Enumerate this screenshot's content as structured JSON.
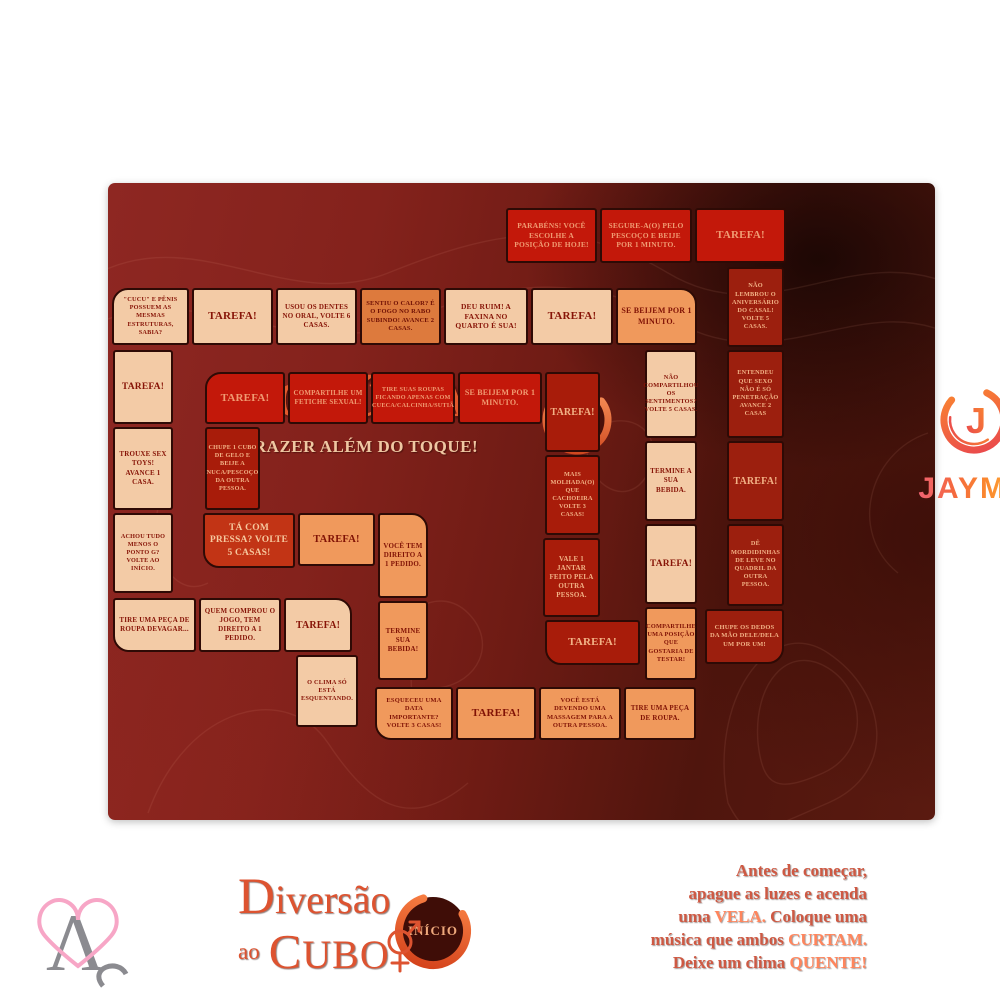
{
  "board": {
    "title": "VOLÚPIA",
    "subtitle": "PRAZER ALÉM DO TOQUE!",
    "end_label": "FIM",
    "start_label": "INÍCIO",
    "brand": {
      "wordmark": "JAYMA",
      "monogram": "J"
    },
    "tagline": {
      "line1": "Diversão",
      "line2_small": "ao",
      "line2_big": "CUBO"
    },
    "intro_lines": [
      [
        {
          "t": "Antes de começar,",
          "b": false
        }
      ],
      [
        {
          "t": "apague as luzes e acenda",
          "b": false
        }
      ],
      [
        {
          "t": "uma ",
          "b": false
        },
        {
          "t": "VELA.",
          "b": true
        },
        {
          "t": " Coloque uma",
          "b": false
        }
      ],
      [
        {
          "t": "música que ambos ",
          "b": false
        },
        {
          "t": "CURTAM.",
          "b": true
        }
      ],
      [
        {
          "t": "Deixe um clima ",
          "b": false
        },
        {
          "t": "QUENTE!",
          "b": true
        }
      ]
    ],
    "tiles": [
      {
        "label": "PARABÉNS! VOCÊ ESCOLHE A POSIÇÃO DE HOJE!",
        "variant": "red",
        "rect": [
          506,
          208,
          91,
          55
        ],
        "round": "none",
        "size": 7.5
      },
      {
        "label": "SEGURE-A(O) PELO PESCOÇO E BEIJE POR 1 MINUTO.",
        "variant": "red",
        "rect": [
          600,
          208,
          92,
          55
        ],
        "round": "none",
        "size": 7.5
      },
      {
        "label": "TAREFA!",
        "variant": "red",
        "rect": [
          695,
          208,
          91,
          55
        ],
        "round": "none",
        "size": 11
      },
      {
        "label": "\"CUCU\" E PÊNIS POSSUEM AS MESMAS ESTRUTURAS, SABIA?",
        "variant": "light",
        "rect": [
          112,
          288,
          77,
          57
        ],
        "round": "tl",
        "size": 6.3
      },
      {
        "label": "TAREFA!",
        "variant": "light",
        "rect": [
          192,
          288,
          81,
          57
        ],
        "round": "none",
        "size": 11
      },
      {
        "label": "USOU OS DENTES NO ORAL, VOLTE 6 CASAS.",
        "variant": "light",
        "rect": [
          276,
          288,
          81,
          57
        ],
        "round": "none",
        "size": 7
      },
      {
        "label": "SENTIU O CALOR? É O FOGO NO RABO SUBINDO! AVANCE 2 CASAS.",
        "variant": "amber",
        "rect": [
          360,
          288,
          81,
          57
        ],
        "round": "none",
        "size": 6.5
      },
      {
        "label": "DEU RUIM! A FAXINA NO QUARTO É SUA!",
        "variant": "light",
        "rect": [
          444,
          288,
          84,
          57
        ],
        "round": "none",
        "size": 7.5
      },
      {
        "label": "TAREFA!",
        "variant": "light",
        "rect": [
          531,
          288,
          82,
          57
        ],
        "round": "none",
        "size": 11
      },
      {
        "label": "SE BEIJEM POR 1 MINUTO.",
        "variant": "orange",
        "rect": [
          616,
          288,
          81,
          57
        ],
        "round": "tr",
        "size": 8
      },
      {
        "label": "NÃO LEMBROU O ANIVERSÁRIO DO CASAL! VOLTE 5 CASAS.",
        "variant": "dark",
        "rect": [
          727,
          267,
          57,
          80
        ],
        "round": "none",
        "size": 6.3
      },
      {
        "label": "ENTENDEU QUE SEXO NÃO É SÓ PENETRAÇÃO AVANCE 2 CASAS",
        "variant": "dark",
        "rect": [
          727,
          350,
          57,
          88
        ],
        "round": "none",
        "size": 6.3
      },
      {
        "label": "TAREFA!",
        "variant": "dark",
        "rect": [
          727,
          441,
          57,
          80
        ],
        "round": "none",
        "size": 10
      },
      {
        "label": "DÊ MORDIDINHAS DE LEVE NO QUADRIL DA OUTRA PESSOA.",
        "variant": "dark",
        "rect": [
          727,
          524,
          57,
          82
        ],
        "round": "none",
        "size": 6.3
      },
      {
        "label": "CHUPE OS DEDOS DA MÃO DELE/DELA UM POR UM!",
        "variant": "dark",
        "rect": [
          705,
          609,
          79,
          55
        ],
        "round": "br",
        "size": 6.5
      },
      {
        "label": "NÃO COMPARTILHOU OS SENTIMENTOS? VOLTE 5 CASAS.",
        "variant": "light",
        "rect": [
          645,
          350,
          52,
          88
        ],
        "round": "none",
        "size": 6.3
      },
      {
        "label": "TERMINE A SUA BEBIDA.",
        "variant": "light",
        "rect": [
          645,
          441,
          52,
          80
        ],
        "round": "none",
        "size": 7
      },
      {
        "label": "TAREFA!",
        "variant": "light",
        "rect": [
          645,
          524,
          52,
          80
        ],
        "round": "none",
        "size": 9.5
      },
      {
        "label": "COMPARTILHE UMA POSIÇÃO QUE GOSTARIA DE TESTAR!",
        "variant": "orange",
        "rect": [
          645,
          607,
          52,
          73
        ],
        "round": "none",
        "size": 6.3
      },
      {
        "label": "TAREFA!",
        "variant": "red",
        "rect": [
          205,
          372,
          80,
          52
        ],
        "round": "tl",
        "size": 11
      },
      {
        "label": "COMPARTILHE UM FETICHE SEXUAL!",
        "variant": "red",
        "rect": [
          288,
          372,
          80,
          52
        ],
        "round": "none",
        "size": 7
      },
      {
        "label": "TIRE SUAS ROUPAS FICANDO APENAS COM CUECA/CALCINHA/SUTIÃ",
        "variant": "red",
        "rect": [
          371,
          372,
          84,
          52
        ],
        "round": "none",
        "size": 6.2
      },
      {
        "label": "SE BEIJEM POR 1 MINUTO.",
        "variant": "red",
        "rect": [
          458,
          372,
          84,
          52
        ],
        "round": "none",
        "size": 8
      },
      {
        "label": "TAREFA!",
        "variant": "dark2",
        "rect": [
          545,
          372,
          55,
          80
        ],
        "round": "none",
        "size": 10
      },
      {
        "label": "MAIS MOLHADA(O) QUE CACHOEIRA VOLTE 3 CASAS!",
        "variant": "dark2",
        "rect": [
          545,
          455,
          55,
          80
        ],
        "round": "none",
        "size": 6.2
      },
      {
        "label": "VALE 1 JANTAR FEITO PELA OUTRA PESSOA.",
        "variant": "dark2",
        "rect": [
          543,
          538,
          57,
          79
        ],
        "round": "none",
        "size": 7
      },
      {
        "label": "TAREFA!",
        "variant": "dark2",
        "rect": [
          545,
          620,
          95,
          45
        ],
        "round": "bl",
        "size": 11
      },
      {
        "label": "TAREFA!",
        "variant": "light",
        "rect": [
          113,
          350,
          60,
          74
        ],
        "round": "none",
        "size": 9.5
      },
      {
        "label": "TROUXE SEX TOYS! AVANCE 1 CASA.",
        "variant": "light",
        "rect": [
          113,
          427,
          60,
          83
        ],
        "round": "none",
        "size": 7
      },
      {
        "label": "ACHOU TUDO MENOS O PONTO G? VOLTE AO INÍCIO.",
        "variant": "light",
        "rect": [
          113,
          513,
          60,
          80
        ],
        "round": "none",
        "size": 6.2
      },
      {
        "label": "TIRE UMA PEÇA DE ROUPA DEVAGAR...",
        "variant": "light",
        "rect": [
          113,
          598,
          83,
          54
        ],
        "round": "bl",
        "size": 7
      },
      {
        "label": "CHUPE 1 CUBO DE GELO E BEIJE A NUCA/PESCOÇO DA OUTRA PESSOA.",
        "variant": "dark2",
        "rect": [
          205,
          427,
          55,
          83
        ],
        "round": "none",
        "size": 6.2
      },
      {
        "label": "TÁ COM PRESSA? VOLTE 5 CASAS!",
        "variant": "red2",
        "rect": [
          203,
          513,
          92,
          55
        ],
        "round": "bl",
        "size": 9.5
      },
      {
        "label": "QUEM COMPROU O JOGO, TEM DIREITO A 1 PEDIDO.",
        "variant": "light",
        "rect": [
          199,
          598,
          82,
          54
        ],
        "round": "none",
        "size": 7
      },
      {
        "label": "TAREFA!",
        "variant": "orange",
        "rect": [
          298,
          513,
          77,
          53
        ],
        "round": "none",
        "size": 10.5
      },
      {
        "label": "VOCÊ TEM DIREITO A 1 PEDIDO.",
        "variant": "orange",
        "rect": [
          378,
          513,
          50,
          85
        ],
        "round": "tr",
        "size": 7
      },
      {
        "label": "TERMINE SUA BEBIDA!",
        "variant": "orange",
        "rect": [
          378,
          601,
          50,
          79
        ],
        "round": "none",
        "size": 7
      },
      {
        "label": "TAREFA!",
        "variant": "light",
        "rect": [
          284,
          598,
          68,
          54
        ],
        "round": "tr",
        "size": 10
      },
      {
        "label": "O CLIMA SÓ ESTÁ ESQUENTANDO.",
        "variant": "light",
        "rect": [
          296,
          655,
          62,
          72
        ],
        "round": "none",
        "size": 6.3
      },
      {
        "label": "ESQUECEU UMA DATA IMPORTANTE? VOLTE 3 CASAS!",
        "variant": "orange",
        "rect": [
          375,
          687,
          78,
          53
        ],
        "round": "bl",
        "size": 6.5
      },
      {
        "label": "TAREFA!",
        "variant": "orange",
        "rect": [
          456,
          687,
          80,
          53
        ],
        "round": "none",
        "size": 11
      },
      {
        "label": "VOCÊ ESTÁ DEVENDO UMA MASSAGEM PARA A OUTRA PESSOA.",
        "variant": "orange",
        "rect": [
          539,
          687,
          82,
          53
        ],
        "round": "none",
        "size": 6.5
      },
      {
        "label": "TIRE UMA PEÇA DE ROUPA.",
        "variant": "orange",
        "rect": [
          624,
          687,
          72,
          53
        ],
        "round": "none",
        "size": 7
      }
    ]
  },
  "colors": {
    "board_maroon": "#84221c",
    "board_dark": "#3a0f08",
    "tile_light": "#f3cba6",
    "tile_orange": "#f0995c",
    "tile_red": "#c3180a",
    "tile_dark": "#9c1f0e",
    "accent_orange": "#e25a2e",
    "cream_text": "#efc7a2",
    "brand_gradient": [
      "#f0608c",
      "#fb8a2e",
      "#ffd84d"
    ]
  },
  "watermark": {
    "letter": "Λ"
  }
}
